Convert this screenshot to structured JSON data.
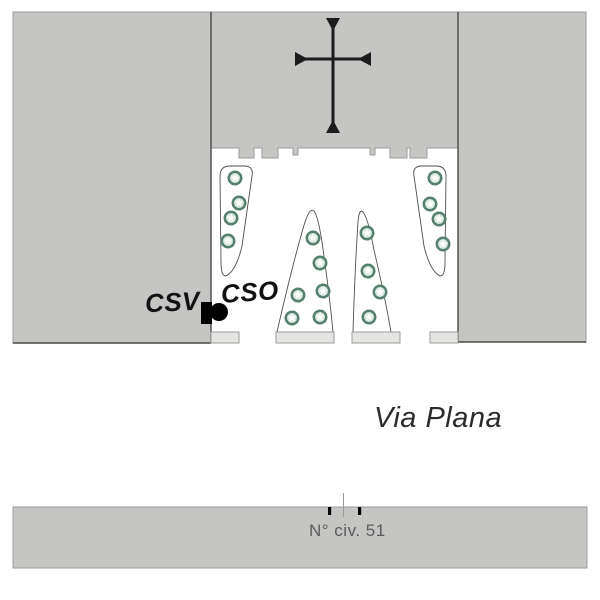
{
  "page": {
    "width": 600,
    "height": 600,
    "background": "#ffffff"
  },
  "labels": {
    "csv": "CSV",
    "cso": "CSO",
    "street": "Via Plana",
    "civic_number": "N° civ. 51"
  },
  "colors": {
    "building_fill": "#c5c5c3",
    "building_outline": "#9b9b99",
    "wall_line": "#4a4a48",
    "plinth_fill": "#e4e4e2",
    "bed_outline": "#4f4f4d",
    "plant_stroke": "#55806d",
    "plant_fill": "#dde9e3",
    "cross_color": "#1c1c1c",
    "marker_color": "#000000",
    "street_text": "#2b2b2b",
    "civic_text": "#5a5a5a",
    "label_text": "#111111",
    "survey_line": "#999997"
  },
  "plants": {
    "radius": 7,
    "positions_by_bed": {
      "left_bed": [
        [
          235,
          178
        ],
        [
          239,
          203
        ],
        [
          231,
          218
        ],
        [
          228,
          241
        ]
      ],
      "center_left_bed": [
        [
          313,
          238
        ],
        [
          320,
          263
        ],
        [
          298,
          295
        ],
        [
          323,
          291
        ],
        [
          292,
          318
        ],
        [
          320,
          317
        ]
      ],
      "center_right_bed": [
        [
          367,
          233
        ],
        [
          368,
          271
        ],
        [
          380,
          292
        ],
        [
          369,
          317
        ]
      ],
      "right_bed": [
        [
          435,
          178
        ],
        [
          430,
          204
        ],
        [
          439,
          219
        ],
        [
          443,
          244
        ]
      ]
    }
  }
}
